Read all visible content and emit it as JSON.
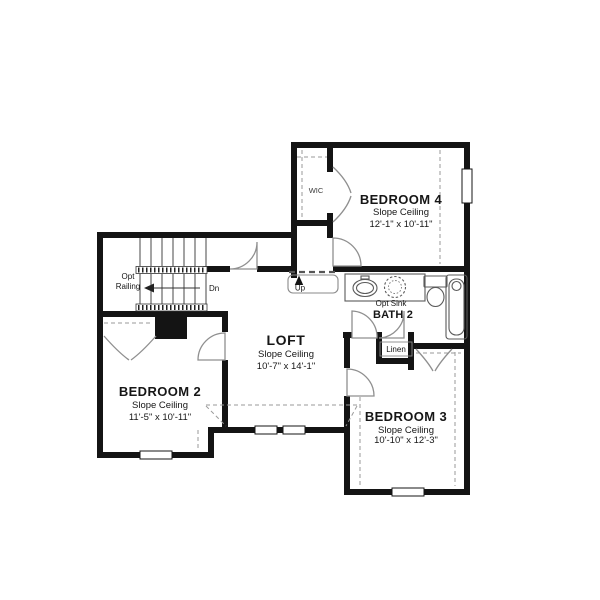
{
  "document": {
    "type": "floor-plan",
    "floor": "second-floor"
  },
  "colors": {
    "wall": "#141414",
    "fixture_line": "#5a5a5a",
    "door_line": "#8f8f8f",
    "dash_line": "#9a9a9a",
    "background": "#ffffff",
    "text": "#161616"
  },
  "rooms": {
    "bedroom4": {
      "name": "BEDROOM 4",
      "ceiling": "Slope Ceiling",
      "dims": "12'-1\" x 10'-11\""
    },
    "bedroom2": {
      "name": "BEDROOM 2",
      "ceiling": "Slope Ceiling",
      "dims": "11'-5\" x 10'-11\""
    },
    "bedroom3": {
      "name": "BEDROOM 3",
      "ceiling": "Slope Ceiling",
      "dims": "10'-10\" x 12'-3\""
    },
    "loft": {
      "name": "LOFT",
      "ceiling": "Slope Ceiling",
      "dims": "10'-7\" x 14'-1\""
    },
    "bath2": {
      "name": "BATH 2"
    }
  },
  "labels": {
    "wic": "WIC",
    "linen": "Linen",
    "down": "Dn",
    "up": "Up",
    "opt_railing_line1": "Opt",
    "opt_railing_line2": "Railing",
    "opt_sink": "Opt Sink"
  }
}
